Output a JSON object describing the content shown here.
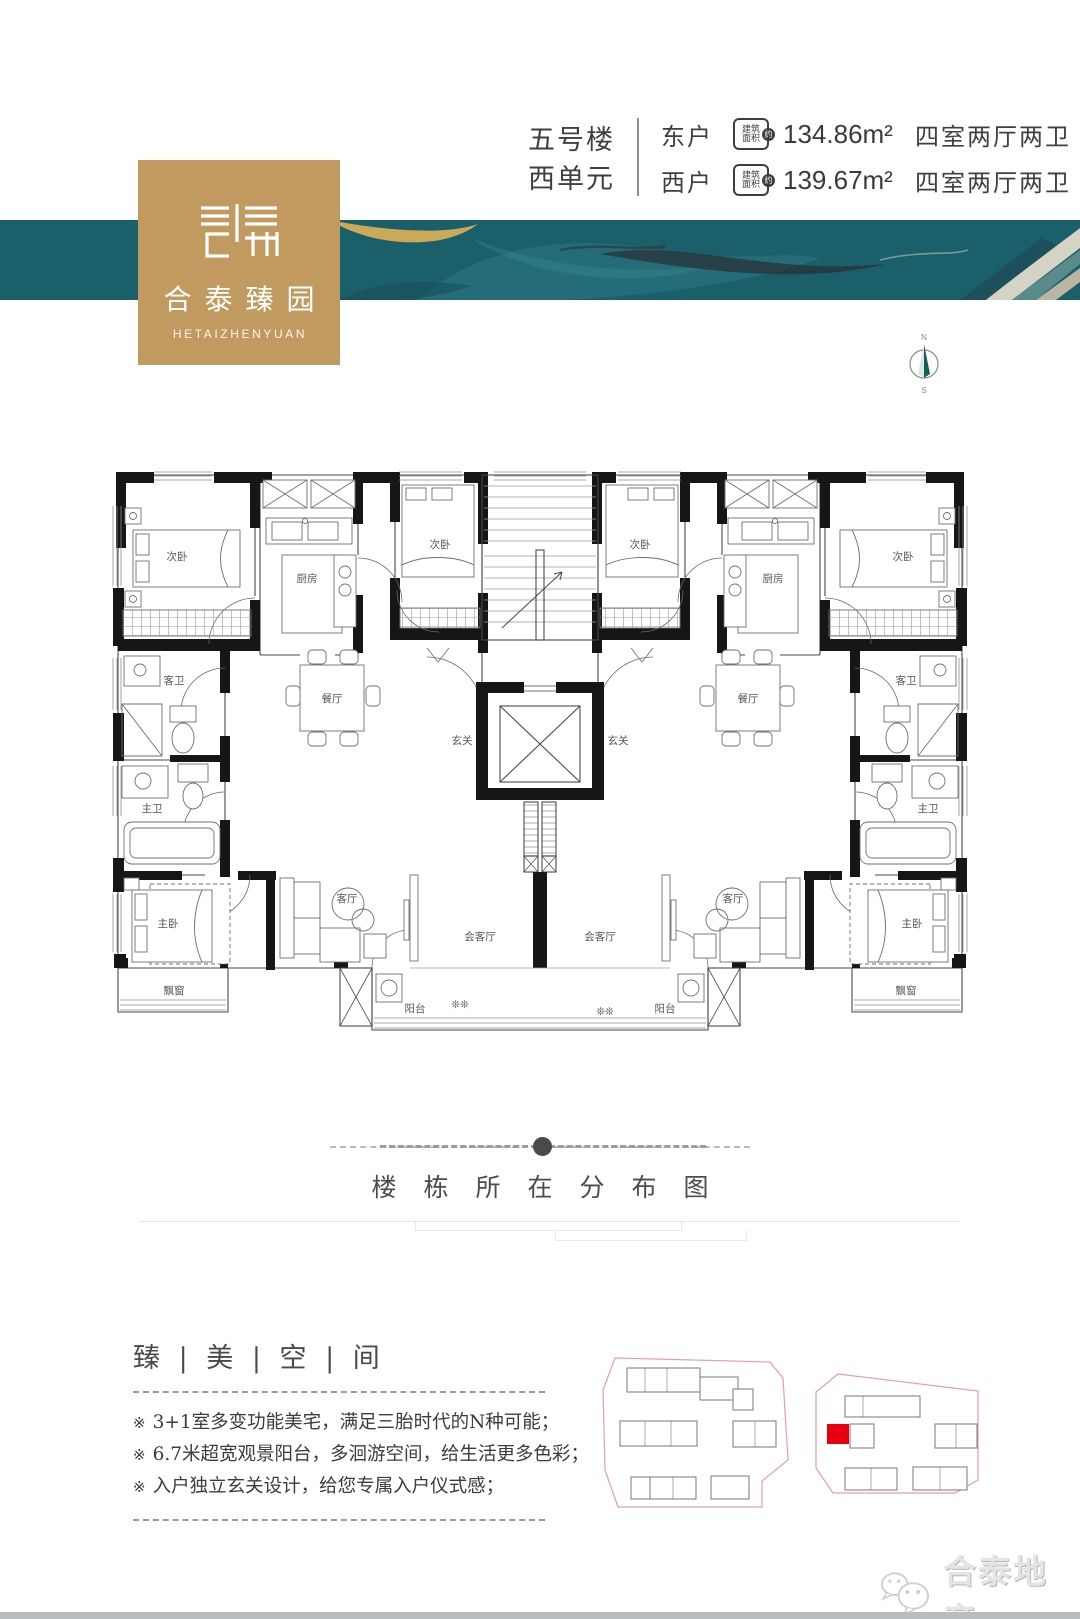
{
  "header": {
    "building": "五号楼",
    "unit": "西单元",
    "badge": {
      "line1": "建筑",
      "line2": "面积",
      "circle": "约"
    },
    "rows": [
      {
        "side": "东户",
        "area": "134.86m²",
        "layout": "四室两厅两卫"
      },
      {
        "side": "西户",
        "area": "139.67m²",
        "layout": "四室两厅两卫"
      }
    ]
  },
  "logo": {
    "title": "合泰臻园",
    "subtitle": "HETAIZHENYUAN"
  },
  "compass": {
    "north": "N",
    "south": "S"
  },
  "floorplan": {
    "left": {
      "bedroom_a": "次卧",
      "kitchen": "厨房",
      "bedroom_b": "次卧",
      "guest_bath": "客卫",
      "master_bath": "主卫",
      "dining": "餐厅",
      "foyer": "玄关",
      "master_bedroom": "主卧",
      "living": "客厅",
      "reception": "会客厅",
      "bay_window": "飘窗",
      "balcony": "阳台"
    },
    "right": {
      "bedroom_a": "次卧",
      "kitchen": "厨房",
      "bedroom_b": "次卧",
      "guest_bath": "客卫",
      "master_bath": "主卫",
      "dining": "餐厅",
      "foyer": "玄关",
      "master_bedroom": "主卧",
      "living": "客厅",
      "reception": "会客厅",
      "bay_window": "飘窗",
      "balcony": "阳台"
    }
  },
  "distribution": {
    "title": "楼栋所在分布图"
  },
  "features": {
    "heading": "臻 | 美 | 空 | 间",
    "bullet": "※",
    "items": [
      "3+1室多变功能美宅，满足三胎时代的N种可能；",
      "6.7米超宽观景阳台，多洄游空间，给生活更多色彩；",
      "入户独立玄关设计，给您专属入户仪式感；"
    ]
  },
  "watermark": {
    "brand": "合泰地产"
  },
  "colors": {
    "banner_teal": "#1b5f6b",
    "brand_gold": "#c19a5f",
    "highlight_red": "#e60012",
    "parcel_outline": "#e2a0a0",
    "wall_black": "#161616"
  }
}
